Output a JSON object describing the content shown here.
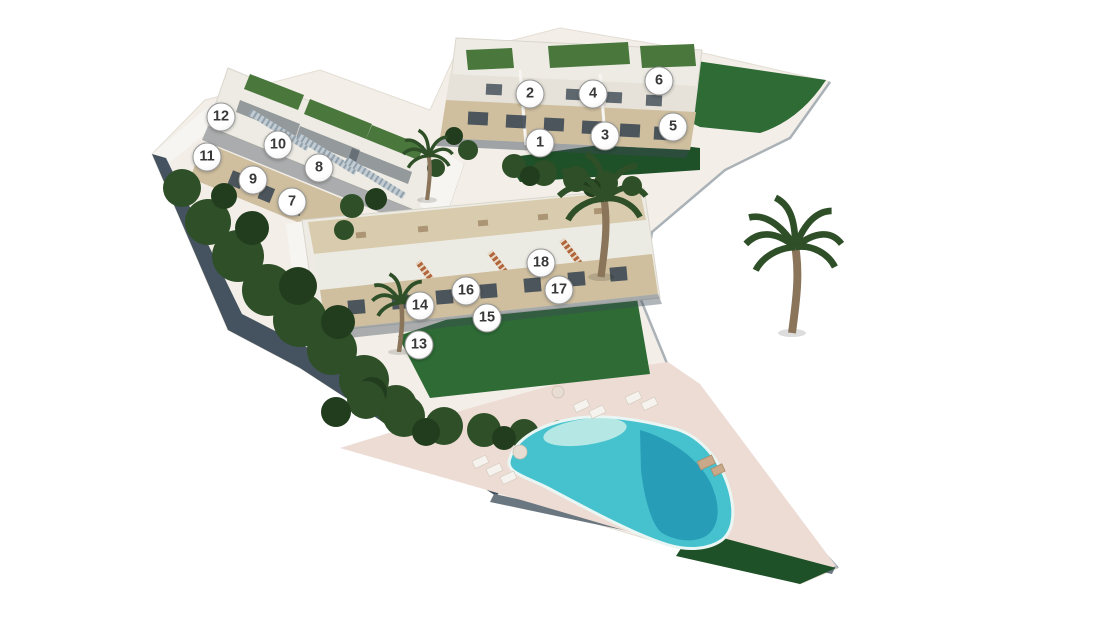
{
  "scene": {
    "type": "aerial-3d-site-plan",
    "description": "bird's-eye render of a hillside residential development with three terraced apartment blocks, numbered unit markers 1-18, gardens and a communal swimming pool",
    "width": 1110,
    "height": 623
  },
  "site": {
    "units": [
      {
        "number": "1",
        "x": 540,
        "y": 143
      },
      {
        "number": "2",
        "x": 530,
        "y": 94
      },
      {
        "number": "3",
        "x": 605,
        "y": 136
      },
      {
        "number": "4",
        "x": 593,
        "y": 94
      },
      {
        "number": "5",
        "x": 673,
        "y": 127
      },
      {
        "number": "6",
        "x": 659,
        "y": 81
      },
      {
        "number": "7",
        "x": 292,
        "y": 202
      },
      {
        "number": "8",
        "x": 319,
        "y": 168
      },
      {
        "number": "9",
        "x": 253,
        "y": 180
      },
      {
        "number": "10",
        "x": 278,
        "y": 145
      },
      {
        "number": "11",
        "x": 207,
        "y": 157
      },
      {
        "number": "12",
        "x": 221,
        "y": 117
      },
      {
        "number": "13",
        "x": 419,
        "y": 345
      },
      {
        "number": "14",
        "x": 420,
        "y": 306
      },
      {
        "number": "15",
        "x": 487,
        "y": 318
      },
      {
        "number": "16",
        "x": 466,
        "y": 291
      },
      {
        "number": "17",
        "x": 559,
        "y": 290
      },
      {
        "number": "18",
        "x": 541,
        "y": 263
      }
    ],
    "buildings": [
      {
        "id": "block-a",
        "position": "top",
        "units": "1-6"
      },
      {
        "id": "block-b",
        "position": "left",
        "units": "7-12"
      },
      {
        "id": "block-c",
        "position": "middle",
        "units": "13-18"
      }
    ],
    "amenities": [
      "swimming-pool",
      "pool-deck",
      "sun-loungers",
      "parasols",
      "palm-trees",
      "lawns",
      "tree-planting"
    ]
  },
  "colors": {
    "page_bg": "#ffffff",
    "ground": "#f3efe8",
    "ground_edge": "#e3ded4",
    "wall": "#44535f",
    "wall_edge": "#6a7680",
    "curb": "#aab2b8",
    "tree": "#2e4f27",
    "tree_dark": "#223d1e",
    "lawn": "#2e6b35",
    "lawn_dark": "#1f5128",
    "roof_green": "#49773c",
    "bldg": "#edebe3",
    "bldg_bright": "#f6f5f1",
    "terrace": "#d9ccae",
    "stone": "#cfbf9f",
    "window": "#3d4a54",
    "stair": "#b0653a",
    "stair_b": "#c3ccd2",
    "deck": "#eddcd4",
    "pool_light": "#c9eee9",
    "pool_main": "#46c2cf",
    "pool_dark": "#2297b4",
    "lounger": "#f6f3ee",
    "daybed": "#c9a98a",
    "trunk": "#8a755a",
    "shadow": "#3c4854",
    "marker_bg": "#ffffff",
    "marker_border": "#979797",
    "marker_text": "#383838"
  }
}
